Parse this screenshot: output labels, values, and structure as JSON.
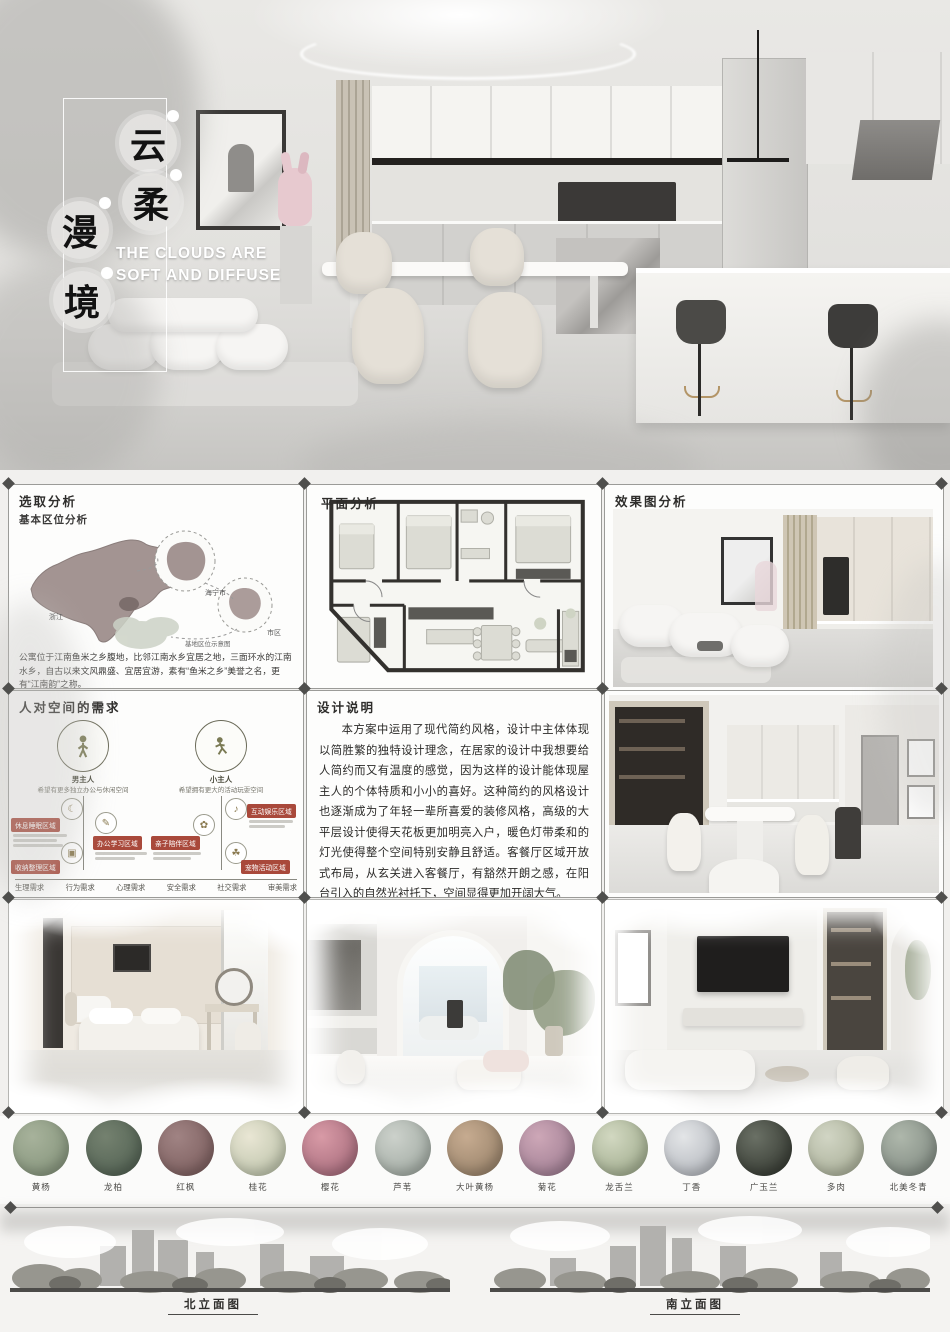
{
  "hero": {
    "title_chars": [
      "云",
      "柔",
      "漫",
      "境"
    ],
    "subtitle_lines": [
      "THE CLOUDS ARE",
      "SOFT AND DIFFUSE"
    ]
  },
  "site": {
    "title": "选取分析",
    "subtitle": "基本区位分析",
    "label_province": "浙江",
    "label_city": "海宁市",
    "label_district": "市区",
    "label_site": "基地区位示意图",
    "caption": "公寓位于江南鱼米之乡腹地，比邻江南水乡宜居之地，三面环水的江南水乡，自古以来文风鼎盛、宜居宜游，素有“鱼米之乡”美誉之名，更有“江南韵”之称。"
  },
  "plan": {
    "title": "平面分析"
  },
  "render": {
    "title": "效果图分析"
  },
  "needs": {
    "title": "人对空间的需求",
    "person1_label": "男主人",
    "person1_desc": "希望有更多独立办公与休闲空间",
    "person2_label": "小主人",
    "person2_desc": "希望拥有更大的活动玩耍空间",
    "tags_left": [
      "休息睡眠区域",
      "办公学习区域",
      "收纳整理区域"
    ],
    "tags_right": [
      "互动娱乐区域",
      "亲子陪伴区域",
      "宠物活动区域"
    ],
    "footer_labels": [
      "生理需求",
      "行为需求",
      "心理需求",
      "安全需求",
      "社交需求",
      "审美需求"
    ]
  },
  "statement": {
    "title": "设计说明",
    "body": "本方案中运用了现代简约风格，设计中主体体现以简胜繁的独特设计理念，在居家的设计中我想要给人简约而又有温度的感觉，因为这样的设计能体现屋主人的个体特质和小小的喜好。这种简约的风格设计也逐渐成为了年轻一辈所喜爱的装修风格，高级的大平层设计使得天花板更加明亮入户，暖色灯带柔和的灯光使得整个空间特别安静且舒适。客餐厅区域开放式布局，从玄关进入客餐厅，有豁然开朗之感，在阳台引入的自然光衬托下，空间显得更加开阔大气。"
  },
  "plants": {
    "items": [
      {
        "name": "黄杨",
        "c1": "#a7b29b",
        "c2": "#7f8f76"
      },
      {
        "name": "龙柏",
        "c1": "#74816f",
        "c2": "#4c5c4e"
      },
      {
        "name": "红枫",
        "c1": "#a08383",
        "c2": "#755757"
      },
      {
        "name": "桂花",
        "c1": "#e9e6d4",
        "c2": "#b4bca2"
      },
      {
        "name": "樱花",
        "c1": "#d89aa6",
        "c2": "#9c6273"
      },
      {
        "name": "芦苇",
        "c1": "#ccd1cb",
        "c2": "#98a29a"
      },
      {
        "name": "大叶黄杨",
        "c1": "#c6ab90",
        "c2": "#8f7a62"
      },
      {
        "name": "菊花",
        "c1": "#cda7b7",
        "c2": "#96758b"
      },
      {
        "name": "龙舌兰",
        "c1": "#d2d8c1",
        "c2": "#96a383"
      },
      {
        "name": "丁香",
        "c1": "#e3e5e7",
        "c2": "#a9adb4"
      },
      {
        "name": "广玉兰",
        "c1": "#6a7065",
        "c2": "#2b2f28"
      },
      {
        "name": "多肉",
        "c1": "#d1d5c4",
        "c2": "#a2a890"
      },
      {
        "name": "北美冬青",
        "c1": "#aeb7ab",
        "c2": "#78827a"
      }
    ]
  },
  "elevations": {
    "north": "北立面图",
    "south": "南立面图"
  }
}
